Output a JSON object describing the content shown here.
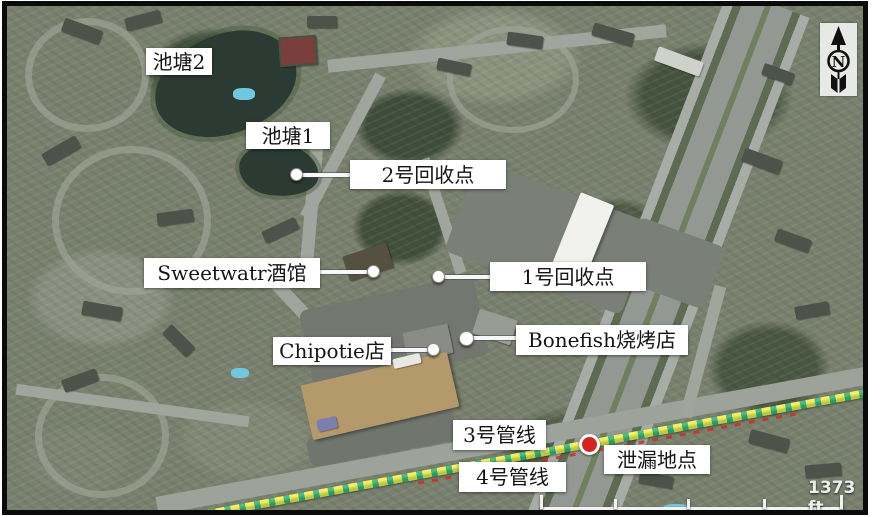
{
  "map": {
    "labels": {
      "pond2": "池塘2",
      "pond1": "池塘1",
      "recovery_point_2": "2号回收点",
      "sweetwater": "Sweetwatr酒馆",
      "recovery_point_1": "1号回收点",
      "chipotle": "Chipotie店",
      "bonefish": "Bonefish烧烤店",
      "pipeline_3": "3号管线",
      "pipeline_4": "4号管线",
      "leak_site": "泄漏地点"
    },
    "scale": {
      "text": "1373 ft"
    },
    "compass": {
      "letter": "N"
    },
    "colors": {
      "pipeline_yellow": "#f4ec48",
      "pipeline_green": "#2fb173",
      "leak_red": "#d42420",
      "label_background": "#ffffff",
      "label_text": "#141414",
      "frame": "#0b0b0b"
    }
  }
}
